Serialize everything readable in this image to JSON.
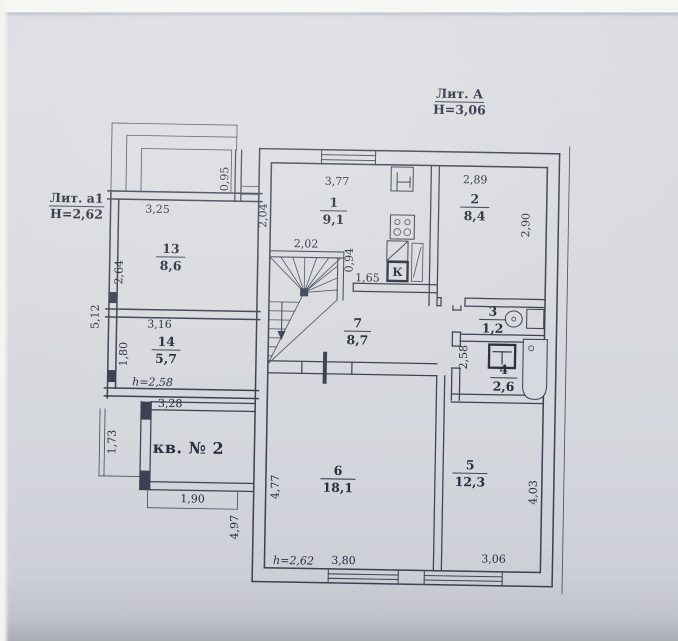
{
  "colors": {
    "paper": "#d6d9df",
    "ink": "#3b4152",
    "text": "#272e3e"
  },
  "titles": {
    "building_liter": "Лит. А",
    "building_height": "Н=3,06",
    "annex_liter": "Лит. а1",
    "annex_height": "Н=2,62",
    "apartment": "кв. № 2",
    "kitchen_mark": "К"
  },
  "rooms": {
    "r1": {
      "number": "1",
      "area": "9,1"
    },
    "r2": {
      "number": "2",
      "area": "8,4"
    },
    "r3": {
      "number": "3",
      "area": "1,2"
    },
    "r4": {
      "number": "4",
      "area": "2,6"
    },
    "r5": {
      "number": "5",
      "area": "12,3"
    },
    "r6": {
      "number": "6",
      "area": "18,1"
    },
    "r7": {
      "number": "7",
      "area": "8,7"
    },
    "r13": {
      "number": "13",
      "area": "8,6"
    },
    "r14": {
      "number": "14",
      "area": "5,7"
    }
  },
  "dims": {
    "d095": "0,95",
    "d377": "3,77",
    "d289": "2,89",
    "d290": "2,90",
    "d204": "2,04",
    "d202": "2,02",
    "d094": "0,94",
    "d165": "1,65",
    "d325": "3,25",
    "d264": "2,64",
    "d512": "5,12",
    "d316": "3,16",
    "d180": "1,80",
    "h258": "h=2,58",
    "d328": "3,28",
    "d173": "1,73",
    "d190": "1,90",
    "d497": "4,97",
    "d477": "4,77",
    "h262": "h=2,62",
    "d380": "3,80",
    "d306": "3,06",
    "d403": "4,03",
    "d258": "2,58"
  }
}
